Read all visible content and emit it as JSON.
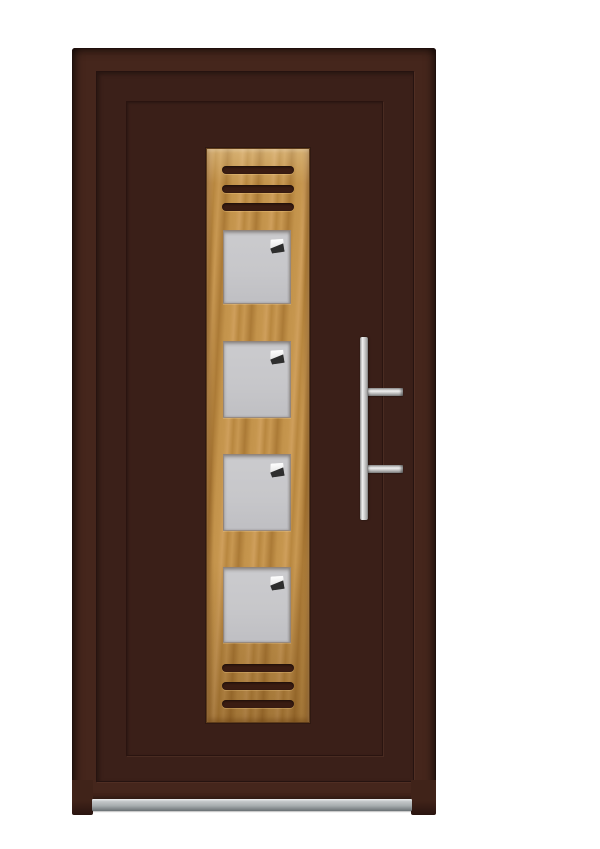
{
  "scene": {
    "type": "product-image",
    "description": "Front entrance door in dark red-brown finish with a central light-oak inlay strip containing three ventilation slots at top, four square frosted glass lites each with a small decorative corner motif, three ventilation slots at bottom, a vertical stainless-steel pull handle with two mounts on the right, and an aluminium threshold sill at the base.",
    "background_color": "#ffffff"
  },
  "door": {
    "finish_color": "#3b2019",
    "frame_face_color": "#45261c",
    "frame_edge_color": "#1f0f0c",
    "groove_color": "#2a1410",
    "glass_lite_count": 4,
    "top_vent_count": 3,
    "bottom_vent_count": 3
  },
  "wood_panel": {
    "material": "light oak",
    "color_light": "#cf9f5c",
    "color_mid": "#c6964e",
    "color_dark": "#ab7a36",
    "border_color": "#5e3c1a"
  },
  "vents": {
    "color": "#3a1c12"
  },
  "glass": {
    "color": "#c8c8cb",
    "corner_motif_white": "#f6f6f6",
    "corner_motif_dark": "#2e2e2e"
  },
  "handle": {
    "type": "vertical pull bar",
    "mount_count": 2,
    "color_light": "#f2f2f2",
    "color_dark": "#787878"
  },
  "sill": {
    "material": "aluminium",
    "color_top": "#eef0f1",
    "color_bottom": "#6a7175"
  }
}
